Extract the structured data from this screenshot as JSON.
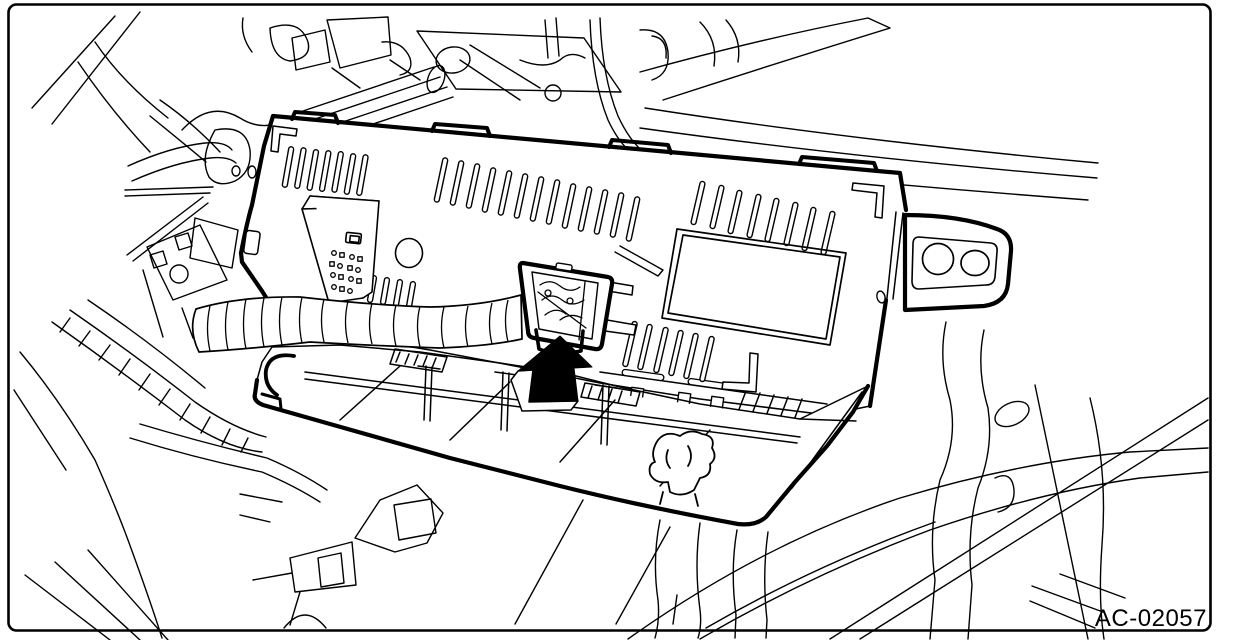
{
  "figure": {
    "code_label": "AC-02057",
    "type": "service-manual-line-illustration",
    "description": "In-dash line drawing: a wiring-harness connector on a corrugated tube is attached to the back of the A/C control unit; a solid black arrow shows the installation direction (upward).",
    "colors": {
      "line": "#000000",
      "background": "#ffffff"
    },
    "parts": [
      {
        "name": "control-unit"
      },
      {
        "name": "control-unit-mounting-bracket"
      },
      {
        "name": "harness-connector"
      },
      {
        "name": "corrugated-harness-tube"
      },
      {
        "name": "lower-mounting-tray"
      },
      {
        "name": "instrument-panel-structure"
      }
    ],
    "callout": {
      "arrow_style": "solid-black",
      "arrow_direction": "up",
      "points_to": "harness-connector"
    }
  }
}
